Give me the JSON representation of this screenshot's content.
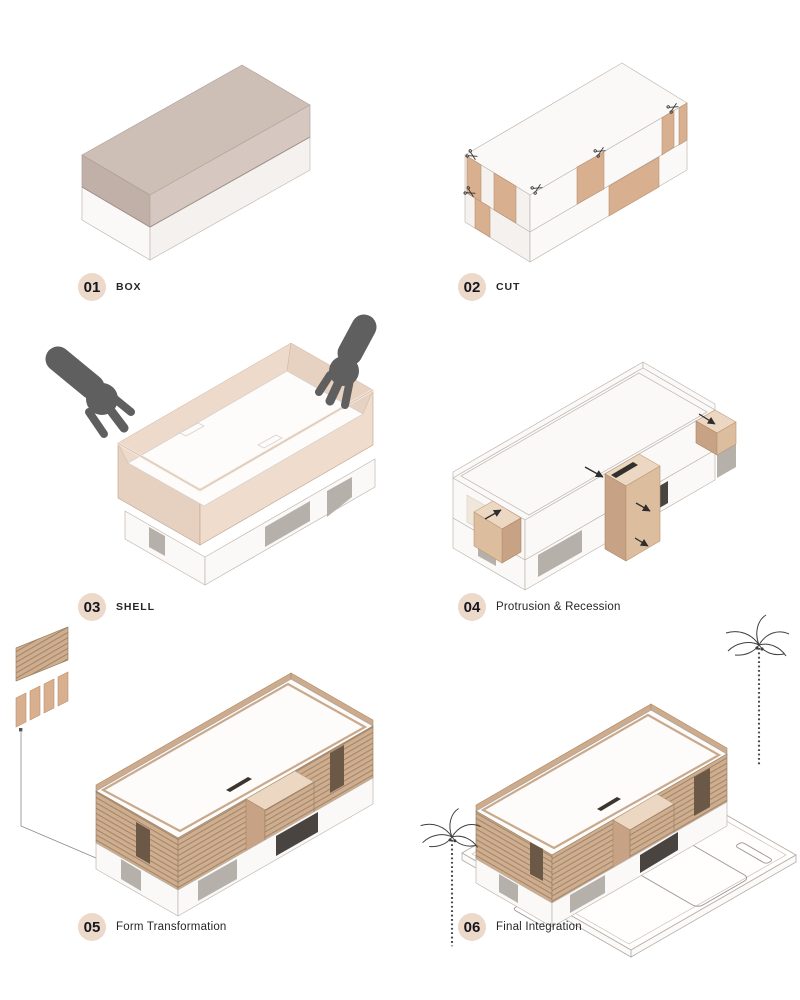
{
  "title": "Architectural form-finding process diagram",
  "steps": [
    {
      "number": "01",
      "label": "BOX"
    },
    {
      "number": "02",
      "label": "CUT"
    },
    {
      "number": "03",
      "label": "SHELL"
    },
    {
      "number": "04",
      "label": "Protrusion & Recession"
    },
    {
      "number": "05",
      "label": "Form Transformation"
    },
    {
      "number": "06",
      "label": "Final Integration"
    }
  ],
  "palette": {
    "badge_bg": "#ecd9ca",
    "badge_text": "#15151f",
    "label_text": "#262626",
    "taupe_top": "#cdbeb6",
    "taupe_left": "#c1b0a8",
    "taupe_right": "#d6c8c1",
    "white_face": "#fbf9f7",
    "tan_panel": "#d8b08f",
    "tan_front": "#dcbd9e",
    "tan_side": "#c8a284",
    "tan_top": "#ecd8c2",
    "shell_left": "#e6d0bf",
    "shell_front": "#efdccc",
    "shell_inner_l": "#eedacb",
    "shell_inner_r": "#e7d1c0",
    "floor_white": "#fdfcfb",
    "hand_gray": "#5f5f5f",
    "opening_gray": "#b5b0aa",
    "glass_dark": "#4a4440",
    "void_dark": "#6b5847",
    "louver_bg": "#cfae8f",
    "louver_line": "#a3866a",
    "parapet_tan": "#cdab8c",
    "ink": "#2e2e2e",
    "palm_ink": "#3f3f3f",
    "ground_line": "#b3ada7"
  }
}
